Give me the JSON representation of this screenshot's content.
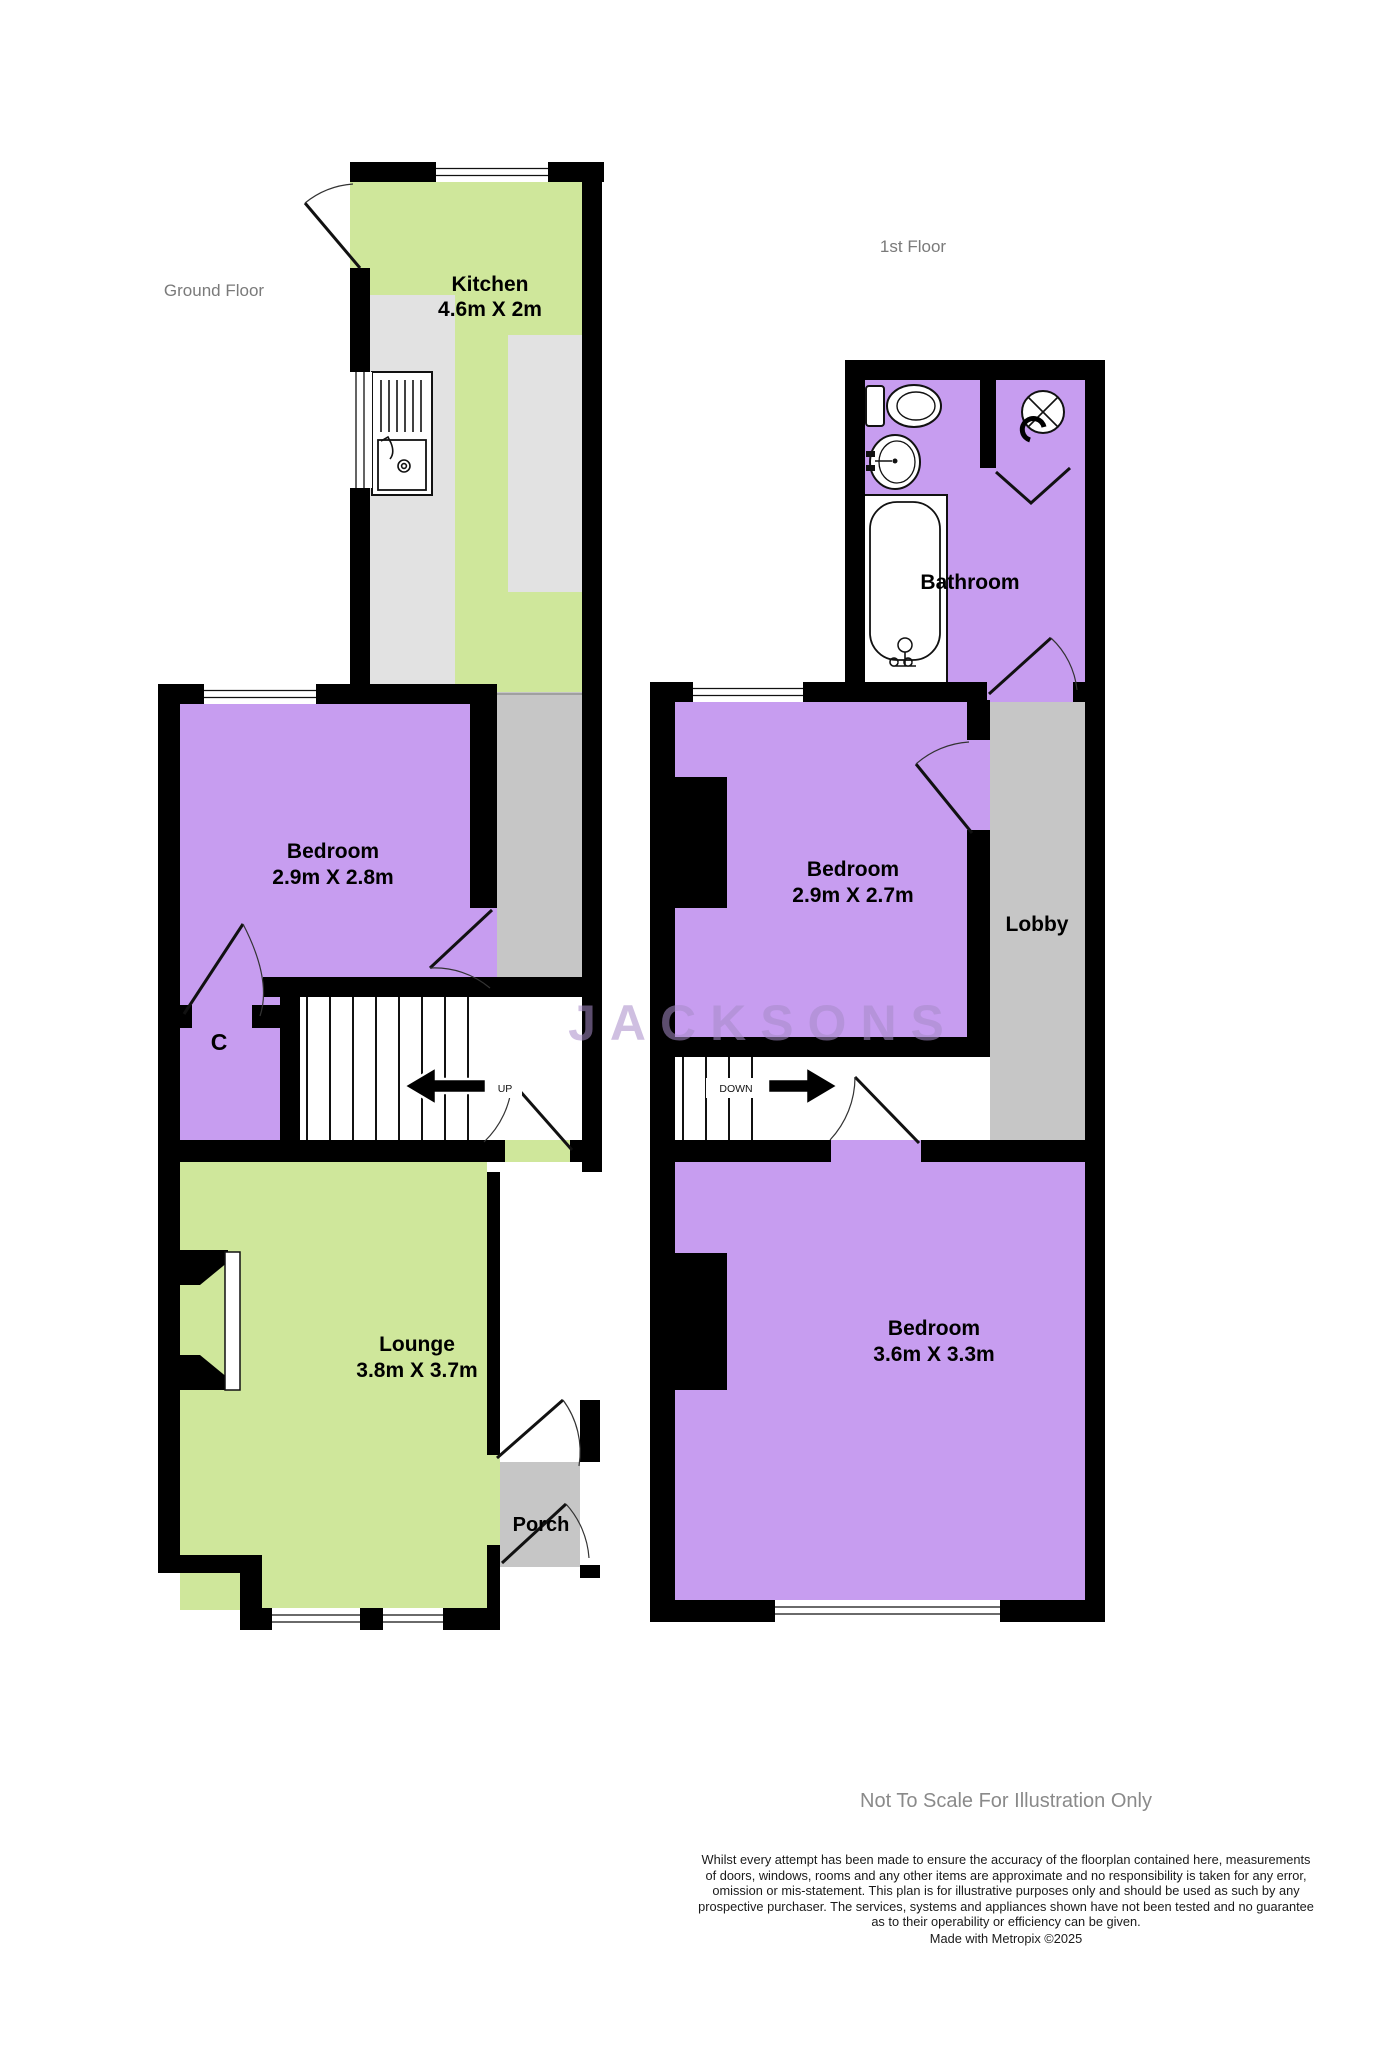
{
  "gf": {
    "title": "Ground Floor",
    "kitchen": {
      "name": "Kitchen",
      "dims": "4.6m X 2m"
    },
    "bedroom": {
      "name": "Bedroom",
      "dims": "2.9m X 2.8m"
    },
    "closet": {
      "label": "C"
    },
    "lounge": {
      "name": "Lounge",
      "dims": "3.8m X 3.7m"
    },
    "porch": {
      "name": "Porch"
    },
    "stair_up": "UP"
  },
  "ff": {
    "title": "1st Floor",
    "bathroom": {
      "name": "Bathroom"
    },
    "bedroom_front": {
      "name": "Bedroom",
      "dims": "2.9m X 2.7m"
    },
    "lobby": {
      "name": "Lobby"
    },
    "bedroom_back": {
      "name": "Bedroom",
      "dims": "3.6m X 3.3m"
    },
    "stair_down": "DOWN"
  },
  "watermark": "JACKSONS",
  "footer": {
    "notice": "Not To Scale For Illustration Only",
    "disclaimer": "Whilst every attempt has been made to ensure the accuracy of the floorplan contained here, measurements\nof doors, windows, rooms and any other items are approximate and no responsibility is taken for any error,\nomission or mis-statement. This plan is for illustrative purposes only and should be used as such by any\nprospective purchaser. The services, systems and appliances shown have not been tested and no guarantee\nas to their operability or efficiency can be given.",
    "credit": "Made with Metropix ©2025"
  },
  "colors": {
    "room_purple": "#c79df0",
    "room_green": "#cfe79b",
    "counter_gray": "#e2e2e2",
    "circulation_gray": "#c6c6c6",
    "wall": "#000000",
    "watermark_purple": "#a88cc9",
    "muted_text": "#7a7a7a"
  }
}
